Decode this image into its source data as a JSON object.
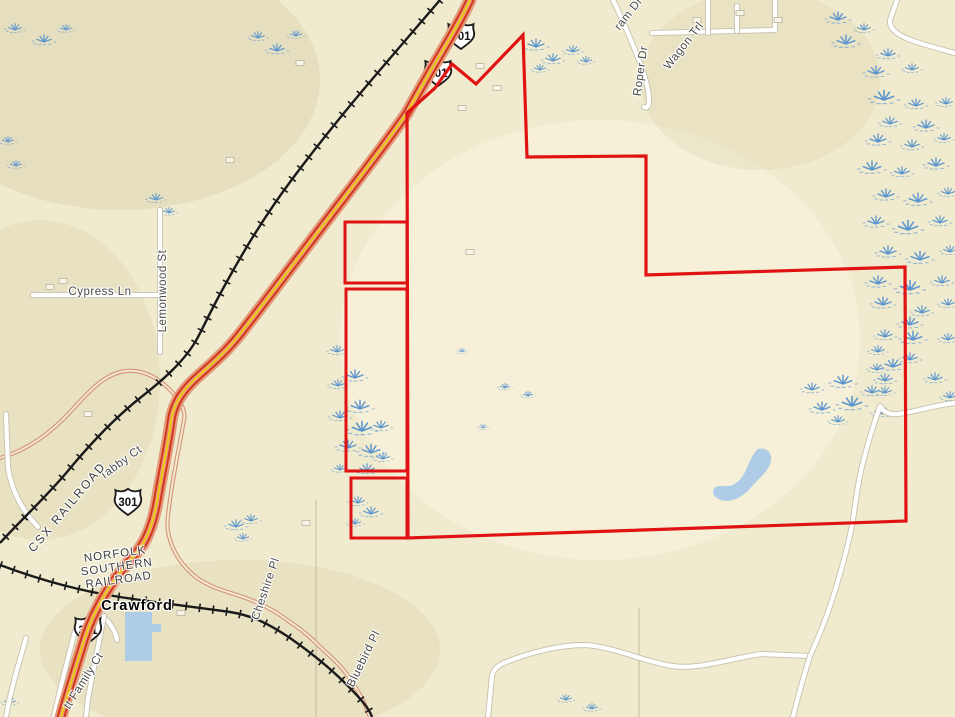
{
  "map": {
    "colors": {
      "background": "#f0ebce",
      "parcel_boundary": "#e01212",
      "water": "#aecbe8",
      "wetland": "#5b95cf",
      "railroad": "#1a1a1a",
      "highway_casing": "#e2997c",
      "highway_stripe": "#d43419",
      "highway_center": "#f2cb0a",
      "minor_road": "#d89078",
      "white_road": "#ffffff",
      "white_road_casing": "#c6c1ad",
      "building_fill": "#f8f5e8",
      "building_stroke": "#b9b4a0",
      "label_color": "#4a4a4a"
    },
    "labels": [
      {
        "text": "ram Dr",
        "x": 629,
        "y": 14,
        "rot": -52,
        "cls": "road"
      },
      {
        "text": "Wagon Trl",
        "x": 684,
        "y": 46,
        "rot": -52,
        "cls": "road"
      },
      {
        "text": "Roper Dr",
        "x": 641,
        "y": 71,
        "rot": -82,
        "cls": "road"
      },
      {
        "text": "Lemonwood St",
        "x": 163,
        "y": 291,
        "rot": -90,
        "cls": "road"
      },
      {
        "text": "Cypress Ln",
        "x": 100,
        "y": 292,
        "rot": 0,
        "cls": "road"
      },
      {
        "text": "Tabby Ct",
        "x": 121,
        "y": 463,
        "rot": -36,
        "cls": "road"
      },
      {
        "text": "CSX RAILROAD",
        "x": 67,
        "y": 507,
        "rot": -50,
        "cls": "rr"
      },
      {
        "lines": [
          "NORFOLK",
          "SOUTHERN",
          "RAILROAD"
        ],
        "x": 117,
        "y": 568,
        "rot": -8,
        "cls": "rrblock"
      },
      {
        "text": "Crawford",
        "x": 137,
        "y": 606,
        "rot": 0,
        "cls": "place"
      },
      {
        "text": "tt Family Ct",
        "x": 84,
        "y": 681,
        "rot": -58,
        "cls": "road"
      },
      {
        "text": "Cheshire Pl",
        "x": 266,
        "y": 589,
        "rot": -71,
        "cls": "road"
      },
      {
        "text": "Bluebird Pl",
        "x": 364,
        "y": 659,
        "rot": -64,
        "cls": "road"
      }
    ],
    "shields": [
      {
        "label": "301",
        "x": 461,
        "y": 36
      },
      {
        "label": "301",
        "x": 438,
        "y": 73
      },
      {
        "label": "301",
        "x": 128,
        "y": 502
      },
      {
        "label": "301",
        "x": 88,
        "y": 630
      }
    ],
    "parcel": {
      "main": [
        [
          407,
          113
        ],
        [
          435,
          88
        ],
        [
          452,
          64
        ],
        [
          476,
          84
        ],
        [
          523,
          35
        ],
        [
          527,
          157
        ],
        [
          646,
          156
        ],
        [
          646,
          275
        ],
        [
          905,
          267
        ],
        [
          906,
          521
        ],
        [
          408,
          538
        ]
      ],
      "rects": [
        [
          345,
          222,
          62,
          61
        ],
        [
          346,
          289,
          61,
          182
        ],
        [
          351,
          478,
          56,
          60
        ]
      ]
    },
    "ponds": [
      "M125,612 L152,612 L152,624 L161,624 L161,632 L152,632 L152,661 L125,661 Z",
      "M758,449 C766,447 772,452 771,460 C770,468 764,474 757,481 C750,488 746,494 738,498 C728,503 718,501 714,495 C711,490 715,485 722,486 C730,487 736,485 742,477 C748,469 750,456 758,449 Z"
    ],
    "wetlands": [
      [
        838,
        20,
        1
      ],
      [
        864,
        30,
        0.8
      ],
      [
        846,
        44,
        1.1
      ],
      [
        888,
        56,
        0.9
      ],
      [
        876,
        74,
        1
      ],
      [
        912,
        70,
        0.8
      ],
      [
        884,
        100,
        1.2
      ],
      [
        916,
        106,
        0.9
      ],
      [
        946,
        104,
        0.8
      ],
      [
        890,
        124,
        0.9
      ],
      [
        926,
        128,
        1
      ],
      [
        878,
        142,
        1
      ],
      [
        912,
        147,
        0.9
      ],
      [
        944,
        140,
        0.8
      ],
      [
        872,
        170,
        1.1
      ],
      [
        902,
        174,
        0.9
      ],
      [
        936,
        166,
        1
      ],
      [
        886,
        197,
        1
      ],
      [
        918,
        202,
        1.1
      ],
      [
        948,
        194,
        0.8
      ],
      [
        876,
        224,
        1
      ],
      [
        908,
        230,
        1.2
      ],
      [
        940,
        223,
        0.9
      ],
      [
        888,
        254,
        1
      ],
      [
        920,
        260,
        1.1
      ],
      [
        950,
        252,
        0.8
      ],
      [
        878,
        284,
        1
      ],
      [
        910,
        290,
        1.2
      ],
      [
        942,
        283,
        0.9
      ],
      [
        883,
        305,
        1
      ],
      [
        922,
        313,
        0.9
      ],
      [
        948,
        305,
        0.8
      ],
      [
        910,
        325,
        1
      ],
      [
        885,
        337,
        0.9
      ],
      [
        913,
        340,
        1.1
      ],
      [
        878,
        352,
        0.8
      ],
      [
        893,
        367,
        1
      ],
      [
        910,
        360,
        0.9
      ],
      [
        877,
        370,
        0.8
      ],
      [
        885,
        381,
        0.9
      ],
      [
        885,
        393,
        0.8
      ],
      [
        948,
        340,
        0.8
      ],
      [
        935,
        380,
        0.9
      ],
      [
        950,
        398,
        0.8
      ],
      [
        812,
        390,
        0.9
      ],
      [
        843,
        384,
        1.1
      ],
      [
        872,
        393,
        0.9
      ],
      [
        822,
        410,
        1
      ],
      [
        852,
        406,
        1.2
      ],
      [
        882,
        414,
        0.9
      ],
      [
        838,
        422,
        0.8
      ],
      [
        337,
        352,
        0.8
      ],
      [
        355,
        378,
        1
      ],
      [
        338,
        386,
        0.8
      ],
      [
        360,
        409,
        1.1
      ],
      [
        340,
        418,
        0.9
      ],
      [
        362,
        431,
        1.2
      ],
      [
        381,
        428,
        0.9
      ],
      [
        348,
        448,
        1
      ],
      [
        371,
        453,
        1.1
      ],
      [
        383,
        459,
        0.8
      ],
      [
        367,
        471,
        0.9
      ],
      [
        340,
        470,
        0.7
      ],
      [
        358,
        503,
        0.8
      ],
      [
        371,
        514,
        0.9
      ],
      [
        355,
        524,
        0.7
      ],
      [
        536,
        47,
        1
      ],
      [
        553,
        61,
        0.9
      ],
      [
        573,
        52,
        0.8
      ],
      [
        586,
        62,
        0.7
      ],
      [
        540,
        70,
        0.7
      ],
      [
        15,
        30,
        0.8
      ],
      [
        44,
        42,
        0.9
      ],
      [
        66,
        30,
        0.7
      ],
      [
        258,
        38,
        0.8
      ],
      [
        277,
        51,
        0.9
      ],
      [
        296,
        36,
        0.7
      ],
      [
        8,
        142,
        0.7
      ],
      [
        16,
        166,
        0.7
      ],
      [
        156,
        200,
        0.8
      ],
      [
        169,
        213,
        0.7
      ],
      [
        236,
        527,
        0.9
      ],
      [
        251,
        521,
        0.8
      ],
      [
        243,
        539,
        0.7
      ],
      [
        10,
        703,
        0.7
      ],
      [
        566,
        700,
        0.7
      ],
      [
        592,
        709,
        0.7
      ],
      [
        505,
        388,
        0.6
      ],
      [
        528,
        396,
        0.6
      ],
      [
        483,
        428,
        0.5
      ],
      [
        462,
        352,
        0.5
      ]
    ],
    "roads": {
      "highway": "M470,0 C460,22 444,48 430,72 C422,86 414,100 407,113 C380,152 345,196 308,245 C285,275 262,306 240,334 C222,357 204,370 192,382 C181,393 173,405 171,422 C167,450 161,478 157,502 C153,524 147,540 137,552 C126,565 113,580 104,596 C95,612 89,624 83,644 C75,670 67,695 61,717",
      "white": [
        "M652,33 L775,30 L775,0",
        "M708,0 L708,33",
        "M737,6 L737,31",
        "M613,0 C622,18 631,40 639,60 C645,76 649,90 649,100 C649,106 647,109 644,107",
        "M897,0 L890,20 C889,28 896,34 908,39 C924,45 940,49 955,53",
        "M160,210 L160,352",
        "M33,295 L160,295",
        "M6,414 L8,468 C12,492 22,510 38,527",
        "M100,614 C109,621 115,630 117,640",
        "M75,631 C67,662 59,692 54,717",
        "M26,638 C18,666 10,693 6,717",
        "M104,616 C99,642 93,672 88,698 L86,717",
        "M488,717 L492,676 C493,670 497,666 504,663 C530,652 560,645 585,645 C615,647 645,662 672,666 C700,670 730,658 762,654 L810,656",
        "M955,403 C935,405 915,412 898,414 C890,415 883,412 880,406 C876,418 869,438 865,455 C860,472 857,490 853,520 C848,548 840,575 832,600 C824,625 815,645 810,656 C802,682 797,700 793,717"
      ],
      "minor": [
        "M0,458 C28,450 52,432 72,410 C90,390 106,373 126,371 C144,369 160,379 172,392 C180,401 186,410 184,420 C181,438 174,470 170,500 C168,515 166,526 169,536 C173,553 183,567 197,578 C212,588 225,591 240,596 C255,601 268,607 280,615 C293,624 305,632 315,642 C327,654 337,661 345,672 C354,684 364,700 370,717"
      ]
    },
    "railroads": [
      "M440,0 L380,70 C350,105 320,142 293,178 C266,214 244,250 225,285 C211,310 203,328 198,337 C186,360 163,380 140,398 C116,417 90,444 67,472 C46,497 20,521 0,543",
      "M0,565 C40,580 80,591 120,597 C160,603 195,607 230,612 C255,616 272,626 290,638 C310,652 330,668 346,684 C360,698 369,708 372,717"
    ],
    "buildings": [
      [
        50,
        287
      ],
      [
        63,
        281
      ],
      [
        230,
        160
      ],
      [
        480,
        66
      ],
      [
        497,
        88
      ],
      [
        462,
        108
      ],
      [
        697,
        20
      ],
      [
        740,
        13
      ],
      [
        181,
        613
      ],
      [
        88,
        414
      ],
      [
        778,
        20
      ],
      [
        300,
        63
      ],
      [
        470,
        252
      ],
      [
        306,
        523
      ]
    ],
    "tints": [
      [
        120,
        80,
        200,
        130,
        "rgba(206,197,158,0.30)"
      ],
      [
        40,
        380,
        120,
        160,
        "rgba(208,199,162,0.25)"
      ],
      [
        240,
        650,
        200,
        90,
        "rgba(206,196,158,0.25)"
      ],
      [
        600,
        340,
        260,
        220,
        "rgba(250,246,226,0.45)"
      ],
      [
        760,
        80,
        120,
        90,
        "rgba(212,204,168,0.25)"
      ]
    ],
    "faint_lines": [
      "M316,500 L316,717",
      "M639,608 L639,717"
    ]
  }
}
